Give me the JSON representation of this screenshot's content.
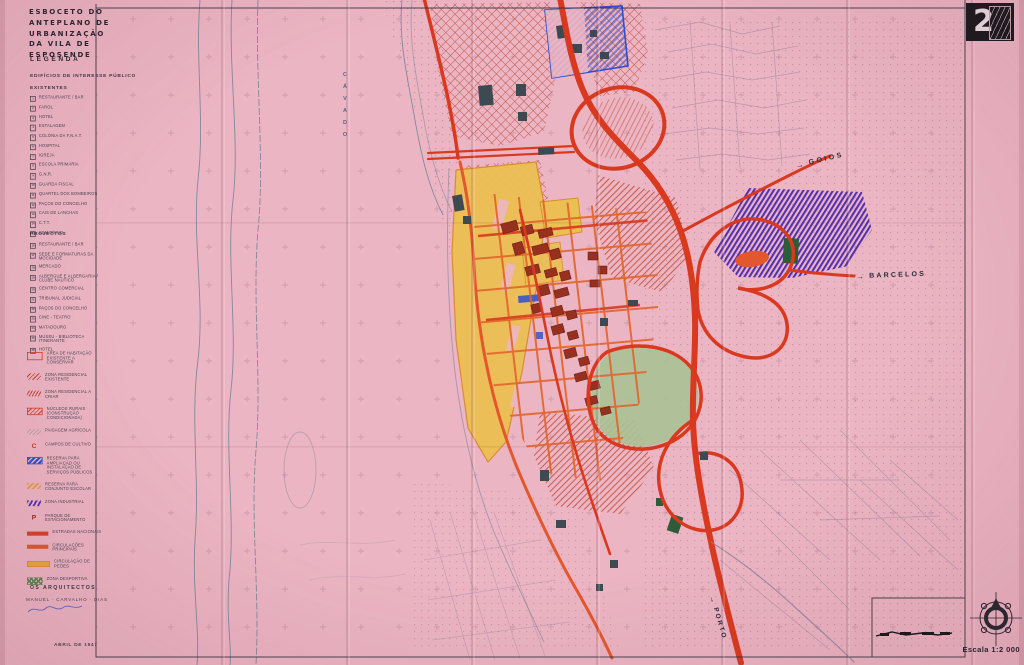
{
  "title": {
    "l1": "ESBOCETO DO",
    "l2": "ANTEPLANO DE",
    "l3": "URBANIZAÇÃO",
    "l4": "DA VILA DE",
    "l5": "ESPOSENDE"
  },
  "legend": {
    "heading": "LEGENDA",
    "section1": "EDIFÍCIOS DE INTERESSE PÚBLICO",
    "existing_heading": "EXISTENTES",
    "existentes": [
      {
        "num": "1",
        "label": "RESTAURANTE / BAR"
      },
      {
        "num": "2",
        "label": "FAROL"
      },
      {
        "num": "3",
        "label": "HOTEL"
      },
      {
        "num": "4",
        "label": "ESTALAGEM"
      },
      {
        "num": "5",
        "label": "COLÓNIA DA F.N.A.T."
      },
      {
        "num": "6",
        "label": "HOSPITAL"
      },
      {
        "num": "7",
        "label": "IGREJA"
      },
      {
        "num": "8",
        "label": "ESCOLA PRIMÁRIA"
      },
      {
        "num": "9",
        "label": "G.N.R."
      },
      {
        "num": "10",
        "label": "GUARDA FISCAL"
      },
      {
        "num": "11",
        "label": "QUARTEL DOS BOMBEIROS"
      },
      {
        "num": "12",
        "label": "PAÇOS DO CONCELHO"
      },
      {
        "num": "13",
        "label": "CAIS DE LANCHAS"
      },
      {
        "num": "14",
        "label": "C.T.T."
      },
      {
        "num": "15",
        "label": "CEMITÉRIO"
      }
    ],
    "projects_heading": "PROJECTOS",
    "projectos": [
      {
        "num": "16",
        "label": "RESTAURANTE / BAR"
      },
      {
        "num": "17",
        "label": "SEDE E FORMATURAS DA MOCIDADE"
      },
      {
        "num": "18",
        "label": "MERCADO"
      },
      {
        "num": "19",
        "label": "ALBERGUE E ALBERGARIA / CLUBE NÁUTICO"
      },
      {
        "num": "20",
        "label": "CENTRO COMERCIAL"
      },
      {
        "num": "21",
        "label": "TRIBUNAL JUDICIAL"
      },
      {
        "num": "22",
        "label": "PAÇOS DO CONCELHO"
      },
      {
        "num": "23",
        "label": "CINE - TEATRO"
      },
      {
        "num": "24",
        "label": "MATADOURO"
      },
      {
        "num": "25",
        "label": "MUSEU - BIBLIOTECA ITINERANTE"
      },
      {
        "num": "26",
        "label": "HOTEL"
      }
    ],
    "zones": [
      {
        "swatch": "z1",
        "label": "ÁREA DE HABITAÇÃO EXISTENTE A CONSERVAR"
      },
      {
        "swatch": "z2",
        "label": "ZONA RESIDENCIAL EXISTENTE"
      },
      {
        "swatch": "z3",
        "label": "ZONA RESIDENCIAL A CRIAR"
      },
      {
        "swatch": "z4",
        "label": "NÚCLEOS RURAIS (CONSTRUÇÃO CONDICIONADA)"
      },
      {
        "swatch": "z5",
        "label": "PAISAGEM AGRÍCOLA"
      },
      {
        "swatch": "zC",
        "glyph": "C",
        "label": "CAMPOS DE CULTIVO"
      },
      {
        "swatch": "z7",
        "label": "RESERVA PARA AMPLIAÇÃO OU INSTALAÇÃO DE SERVIÇOS PÚBLICOS"
      },
      {
        "swatch": "z8",
        "label": "RESERVA PARA CONJUNTO ESCOLAR"
      },
      {
        "swatch": "z9",
        "label": "ZONA INDUSTRIAL"
      },
      {
        "swatch": "zP",
        "glyph": "P",
        "label": "PARQUE DE ESTACIONAMENTO"
      },
      {
        "swatch": "r1",
        "label": "ESTRADAS NACIONAIS",
        "gap_class": "gap"
      },
      {
        "swatch": "r2",
        "label": "CIRCULAÇÕES PRINCIPAIS"
      },
      {
        "swatch": "r3",
        "label": "CIRCULAÇÃO DE PEÕES"
      },
      {
        "swatch": "r4",
        "label": "ZONA DESPORTIVA"
      }
    ]
  },
  "map_labels": {
    "river": "CÁVADO",
    "goios": "GOIOS",
    "barcelos": "BARCELOS",
    "porto": "PORTO",
    "arrow": "→"
  },
  "footer": {
    "architects_heading": "OS ARQUITECTOS",
    "architects_names": "MANUEL · CARVALHO · DIAS",
    "date": "ABRIL DE 1947"
  },
  "corner": {
    "sheet_number": "2",
    "scale_label": "Escala 1:2 000"
  },
  "colors": {
    "paper_pink": "#ecb5c3",
    "road_red": "#d8391f",
    "road_orange": "#e2572b",
    "pedestrian_yellow": "#e8a83f",
    "zone_yellow": "#ecbf52",
    "public_blue": "#2d4fd0",
    "industrial_purple": "#5230b2",
    "sports_green": "#9fbc8c",
    "ink": "#2e2a35"
  }
}
